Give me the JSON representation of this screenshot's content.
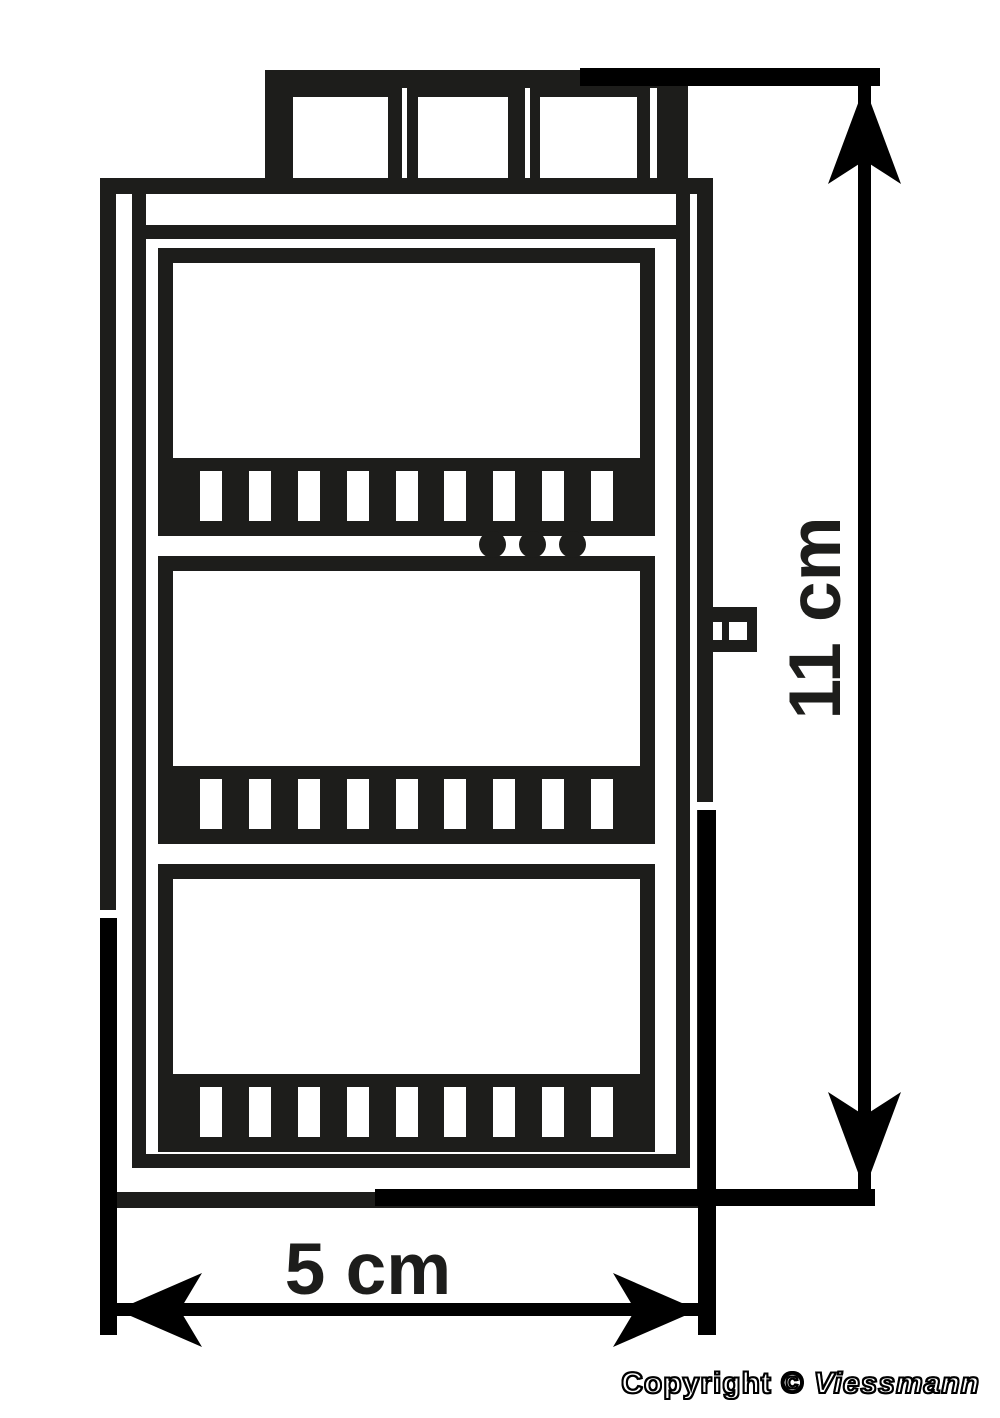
{
  "page": {
    "background": "#ffffff",
    "ink": "#1d1d1b",
    "dimension_color": "#000000"
  },
  "dimensions": {
    "height_label": "11 cm",
    "width_label": "5 cm"
  },
  "footer": {
    "copyright": "Copyright © ",
    "brand": "Viessmann"
  },
  "figure": {
    "type": "technical-drawing",
    "view": "front-elevation",
    "panels": 3,
    "slats_per_panel": 9,
    "roof_openings": 3,
    "indicator_dots": 3
  }
}
